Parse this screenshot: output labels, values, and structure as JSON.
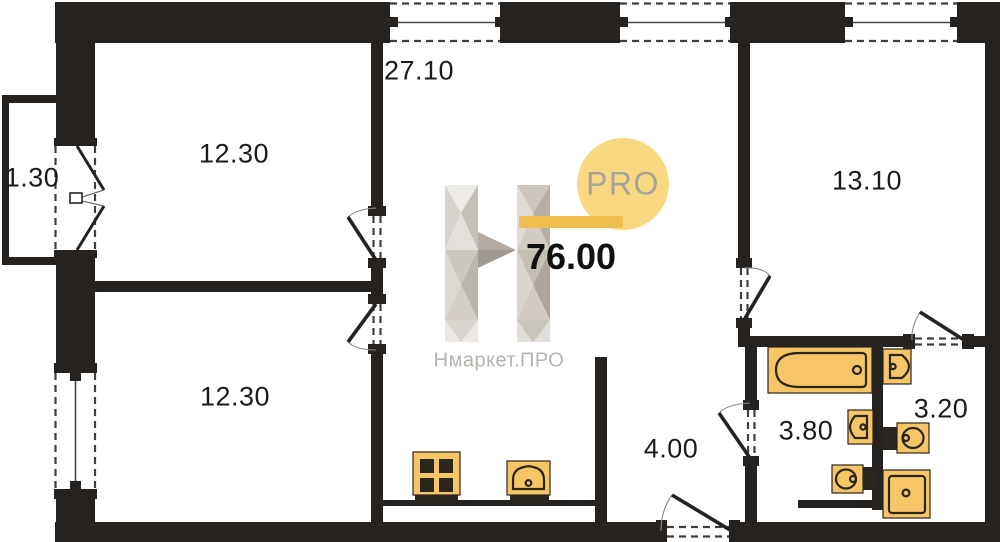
{
  "plan_type": "apartment-floor-plan",
  "total_area": "76.00",
  "watermark": {
    "pro_badge": "PRO",
    "brand_name": "Нмаркет.ПРО"
  },
  "rooms": [
    {
      "name": "kitchen-living-room",
      "area": "27.10"
    },
    {
      "name": "bedroom-top-left",
      "area": "12.30"
    },
    {
      "name": "balcony",
      "area": "1.30"
    },
    {
      "name": "bedroom-bottom-left",
      "area": "12.30"
    },
    {
      "name": "bedroom-right",
      "area": "13.10"
    },
    {
      "name": "hallway",
      "area": "4.00"
    },
    {
      "name": "bathroom",
      "area": "3.80"
    },
    {
      "name": "wc",
      "area": "3.20"
    }
  ],
  "fixtures": [
    "bathtub",
    "wash-basin",
    "toilet",
    "shower-tray",
    "wash-basin",
    "toilet",
    "stove",
    "kitchen-sink"
  ],
  "colors": {
    "wall": "#262220",
    "fixture-fill": "#f6c666",
    "fixture-stroke": "#2b2520",
    "accent-circle": "#f8d981",
    "accent-bar": "#f1bd4b",
    "pro-text": "#a5a19b",
    "brand-text": "#b6b2ad",
    "label": "#1b1b1b"
  }
}
